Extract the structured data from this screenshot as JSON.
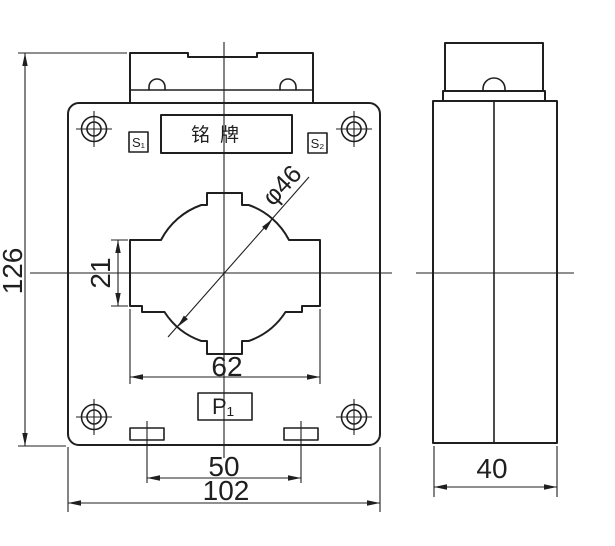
{
  "drawing": {
    "front_view": {
      "nameplate_text": "铭牌",
      "terminal_s1": "S₁",
      "terminal_s2": "S₂",
      "terminal_p1": "P₁",
      "dim_overall_height": "126",
      "dim_window_side_height": "21",
      "dim_window_width": "62",
      "dim_slot_spacing": "50",
      "dim_overall_width": "102",
      "dim_aperture_diameter": "φ46"
    },
    "side_view": {
      "dim_depth": "40"
    },
    "colors": {
      "line": "#1f1f1f",
      "background": "#ffffff"
    }
  }
}
